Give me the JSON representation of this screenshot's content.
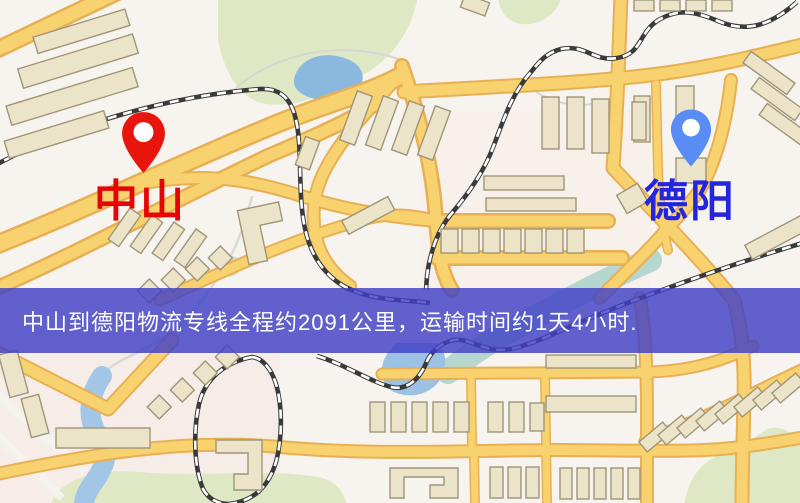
{
  "map": {
    "origin": {
      "name": "中山",
      "pin_color": "#e8150d",
      "label_color": "#e60404"
    },
    "destination": {
      "name": "德阳",
      "pin_color": "#5a8cf5",
      "label_color": "#2525dd"
    },
    "banner": {
      "text": "中山到德阳物流专线全程约2091公里，运输时间约1天4小时.",
      "background_color": "#4040c6",
      "text_color": "#ffffff"
    },
    "palette": {
      "background": "#f7f3ee",
      "road_fill": "#f6d272",
      "road_edge": "#e7b057",
      "park": "#dfe8c6",
      "water": "#9cc2e4",
      "building": "#ece4c9",
      "building_outline": "#a1957a",
      "railway": "#3a3a3a"
    }
  }
}
